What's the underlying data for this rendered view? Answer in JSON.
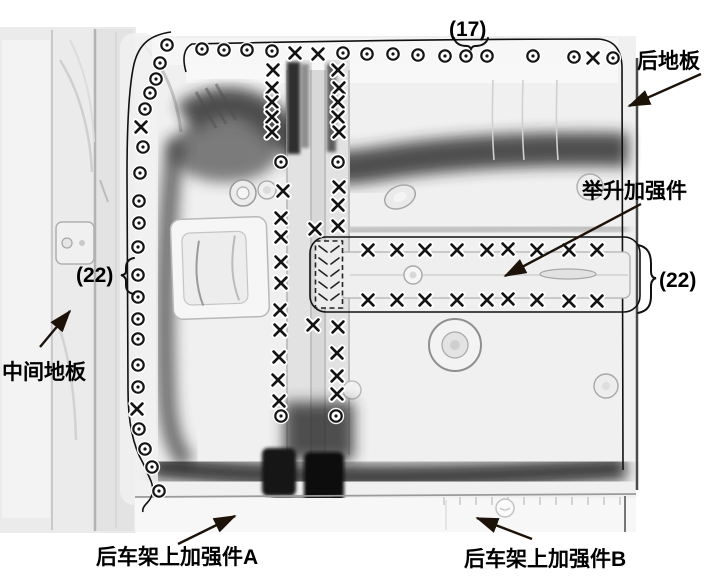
{
  "ink": "#141414",
  "arrow_color": "#1c1208",
  "labels": {
    "count_top": "(17)",
    "rear_floor": "后地板",
    "lift_reinforcement": "举升加强件",
    "count_left": "(22)",
    "count_right": "(22)",
    "middle_floor": "中间地板",
    "rear_frame_a": "后车架上加强件A",
    "rear_frame_b": "后车架上加强件B"
  },
  "arrows": [
    {
      "name": "rear-floor-arrow",
      "x1": 701,
      "y1": 74,
      "x2": 629,
      "y2": 106
    },
    {
      "name": "lift-reinforcement-arrow",
      "x1": 641,
      "y1": 204,
      "x2": 505,
      "y2": 276
    },
    {
      "name": "middle-floor-arrow",
      "x1": 40,
      "y1": 347,
      "x2": 70,
      "y2": 311
    },
    {
      "name": "rear-frame-a-arrow",
      "x1": 178,
      "y1": 544,
      "x2": 235,
      "y2": 516
    },
    {
      "name": "rear-frame-b-arrow",
      "x1": 532,
      "y1": 539,
      "x2": 477,
      "y2": 518
    }
  ],
  "welds": {
    "circle_marks": [
      [
        202,
        49
      ],
      [
        224,
        50
      ],
      [
        247,
        50
      ],
      [
        272,
        51
      ],
      [
        343,
        53
      ],
      [
        367,
        54
      ],
      [
        393,
        54
      ],
      [
        418,
        55
      ],
      [
        445,
        56
      ],
      [
        466,
        56
      ],
      [
        487,
        56
      ],
      [
        533,
        56
      ],
      [
        574,
        57
      ],
      [
        613,
        58
      ],
      [
        167,
        45
      ],
      [
        160,
        63
      ],
      [
        156,
        79
      ],
      [
        150,
        93
      ],
      [
        145,
        109
      ],
      [
        143,
        147
      ],
      [
        140,
        173
      ],
      [
        139,
        201
      ],
      [
        139,
        223
      ],
      [
        138,
        247
      ],
      [
        138,
        275
      ],
      [
        138,
        297
      ],
      [
        138,
        319
      ],
      [
        138,
        339
      ],
      [
        138,
        365
      ],
      [
        138,
        387
      ],
      [
        139,
        429
      ],
      [
        145,
        449
      ],
      [
        152,
        467
      ],
      [
        159,
        491
      ],
      [
        281,
        162
      ],
      [
        338,
        162
      ],
      [
        281,
        416
      ],
      [
        336,
        416
      ]
    ],
    "x_marks": [
      [
        295,
        53
      ],
      [
        318,
        54
      ],
      [
        593,
        58
      ],
      [
        141,
        127
      ],
      [
        137,
        409
      ],
      [
        273,
        70
      ],
      [
        272,
        88
      ],
      [
        272,
        102
      ],
      [
        272,
        117
      ],
      [
        272,
        132
      ],
      [
        283,
        191
      ],
      [
        281,
        218
      ],
      [
        281,
        237
      ],
      [
        281,
        262
      ],
      [
        281,
        283
      ],
      [
        280,
        310
      ],
      [
        280,
        330
      ],
      [
        279,
        357
      ],
      [
        278,
        380
      ],
      [
        279,
        401
      ],
      [
        338,
        70
      ],
      [
        339,
        88
      ],
      [
        338,
        102
      ],
      [
        338,
        117
      ],
      [
        339,
        132
      ],
      [
        339,
        187
      ],
      [
        338,
        205
      ],
      [
        338,
        226
      ],
      [
        338,
        327
      ],
      [
        337,
        353
      ],
      [
        337,
        376
      ],
      [
        337,
        394
      ],
      [
        315,
        229
      ],
      [
        313,
        325
      ],
      [
        368,
        250
      ],
      [
        397,
        250
      ],
      [
        425,
        250
      ],
      [
        457,
        250
      ],
      [
        487,
        250
      ],
      [
        508,
        249
      ],
      [
        537,
        250
      ],
      [
        569,
        250
      ],
      [
        597,
        250
      ],
      [
        368,
        300
      ],
      [
        397,
        300
      ],
      [
        425,
        300
      ],
      [
        457,
        300
      ],
      [
        487,
        300
      ],
      [
        508,
        299
      ],
      [
        537,
        300
      ],
      [
        569,
        301
      ],
      [
        597,
        301
      ]
    ]
  }
}
